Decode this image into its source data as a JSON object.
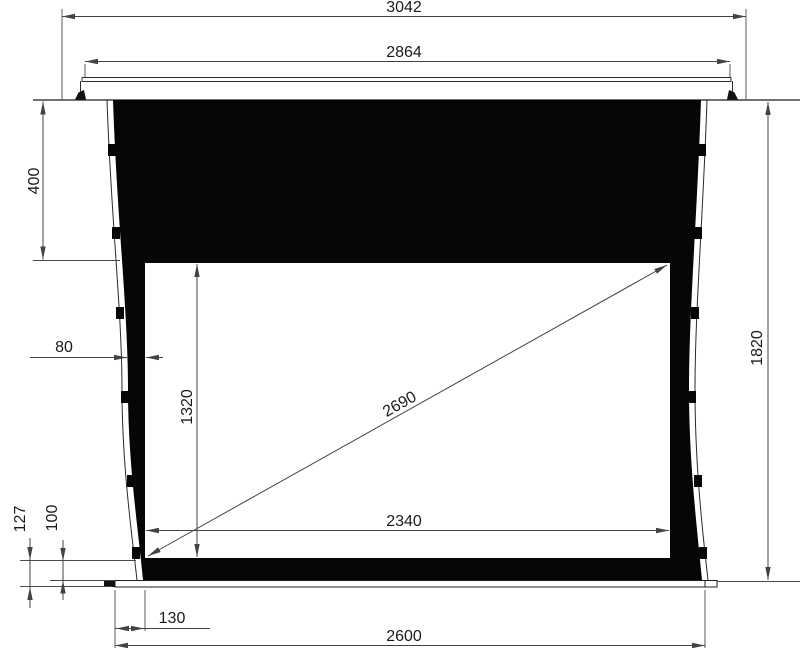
{
  "diagram": {
    "kind": "technical-drawing",
    "subject": "recessed tab-tensioned projection screen, front view with dimensions",
    "colors": {
      "background": "#ffffff",
      "screen_black": "#060606",
      "dimension_line": "#434343",
      "text": "#1a1a1a"
    },
    "dimensions": {
      "overall_width": "3042",
      "case_width": "2864",
      "top_border_height": "400",
      "side_border_width": "80",
      "viewing_height": "1320",
      "diagonal": "2690",
      "viewing_width": "2340",
      "overall_height": "1820",
      "bottom_total_height": "127",
      "bottom_border_height": "100",
      "bar_side_offset": "130",
      "bottom_bar_width": "2600"
    }
  }
}
